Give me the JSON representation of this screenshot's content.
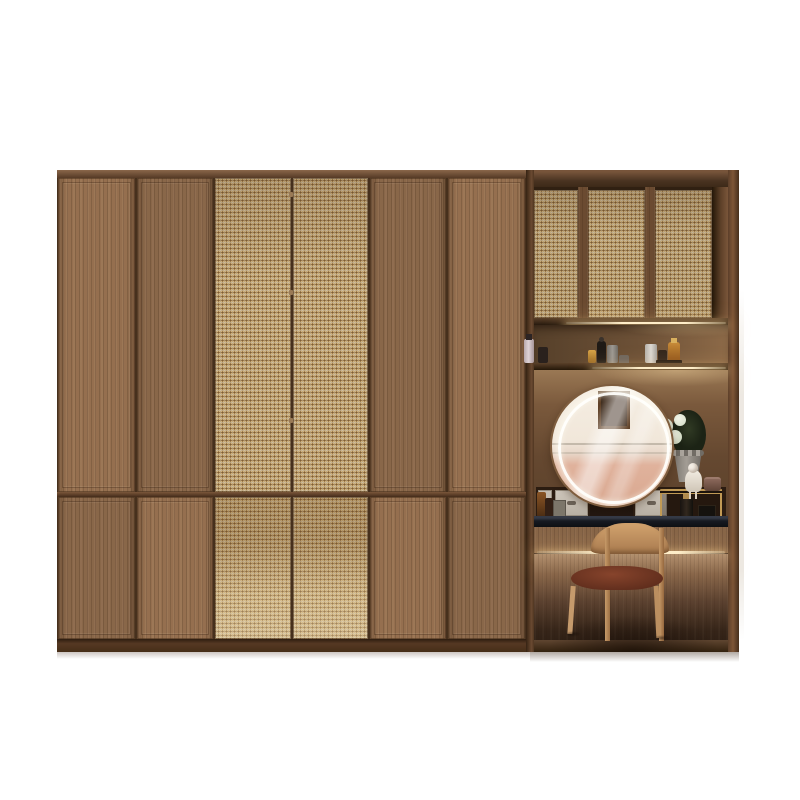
{
  "meta": {
    "type": "product-photo",
    "subject": "Wood wardrobe with rattan cane doors and built-in dressing table nook",
    "background_color": "#ffffff"
  },
  "labels": {
    "scene": "Wardrobe with integrated vanity dressing area",
    "wardrobe": "Six-door wardrobe, two rattan cane doors",
    "vanity_tower": "Dressing nook with rattan upper cabinets and lit shelves",
    "upper_cabinet": "Three rattan-front upper cabinet doors",
    "cosmetics_shelf": "Open shelf with cosmetic bottles and LED lighting",
    "mirror": "Round LED vanity mirror reflecting a room wall",
    "flowers": "White flower bouquet in gray fluted vase",
    "organizer": "Gold two-tier vanity organizer with perfume and doll",
    "drawers": "Three small vanity drawers with metal pulls",
    "counter": "Black stone vanity countertop",
    "chair": "Wooden chair with dark leather seat",
    "plinth": "Dark wood plinth base"
  },
  "colors": {
    "wood": "#8f6b4c",
    "wood_dark": "#5c3f2a",
    "rattan": "#d2b47c",
    "rattan_weave": "#8a6538",
    "counter": "#15171d",
    "led_glow": "#ffeec9",
    "drawer_front": "#c9c1b6",
    "chair_wood": "#c59a6c",
    "chair_seat": "#6f3524",
    "mirror_wall": "#f3ebdf",
    "mirror_wall_pink": "#deac95",
    "organizer_gold": "#c19a55",
    "background": "#ffffff"
  },
  "furniture": {
    "wardrobe": {
      "doors": [
        "wood",
        "wood",
        "rattan",
        "rattan",
        "wood",
        "wood"
      ],
      "rows": 2
    },
    "vanity": {
      "upper_doors": 3,
      "open_shelves": 2,
      "drawers": 3,
      "mirror": "round-led",
      "chair": "wood frame, leather seat"
    },
    "decor": [
      "spray-bottle",
      "perfume-bottles",
      "cosmetic-jars",
      "flower-vase",
      "porcelain-doll",
      "hat-box",
      "gold-organizer"
    ]
  }
}
